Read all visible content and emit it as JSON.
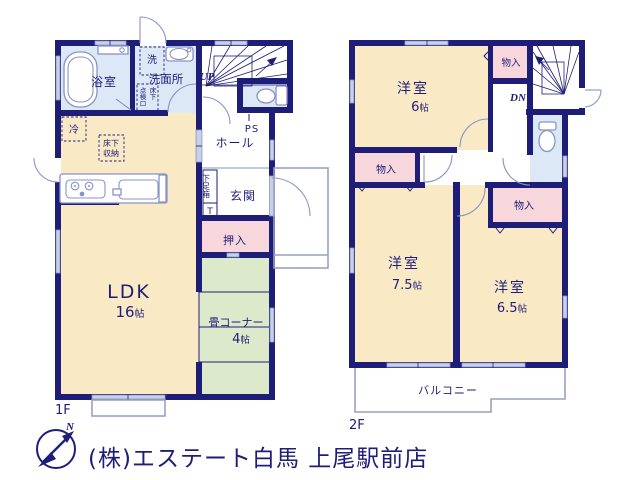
{
  "colors": {
    "wall": "#1e1e78",
    "cream": "#f9e9c5",
    "pink": "#f7d6dc",
    "green": "#dde9cb",
    "blue": "#dce8f5",
    "line": "#8a93c8",
    "window": "#c9d0e6",
    "balcony_line": "#99a1c4",
    "footer_gray": "#dedede",
    "text": "#1e1e78"
  },
  "floor1": {
    "label": "1F",
    "rooms": {
      "bathroom": "浴室",
      "washer": "洗",
      "washroom": "洗面所",
      "hall": "ホール",
      "entrance": "玄関",
      "closet": "押入",
      "ldk": "LDK",
      "tatami": "畳コーナー"
    },
    "sizes": {
      "ldk_num": "16",
      "ldk_unit": "帖",
      "tatami_num": "4",
      "tatami_unit": "帖"
    },
    "annotations": {
      "up": "UP",
      "ps": "PS",
      "fridge": "冷",
      "underfloor_1": "床下",
      "underfloor_2": "収納",
      "hatch_col_left": "点検口",
      "hatch_col_right": "床下",
      "shoebox": "下足箱",
      "shoebox_t": "T"
    }
  },
  "floor2": {
    "label": "2F",
    "rooms": {
      "bedroom1": "洋室",
      "bedroom2": "洋室",
      "bedroom3": "洋室",
      "closet_top": "物入",
      "closet_left": "物入",
      "closet_right": "物入",
      "balcony": "バルコニー"
    },
    "sizes": {
      "b1_num": "6",
      "b1_unit": "帖",
      "b2_num": "7.5",
      "b2_unit": "帖",
      "b3_num": "6.5",
      "b3_unit": "帖"
    },
    "annotations": {
      "dn": "DN"
    }
  },
  "footer": {
    "company": "(株)エステート白馬 上尾駅前店",
    "compass_north": "N"
  }
}
